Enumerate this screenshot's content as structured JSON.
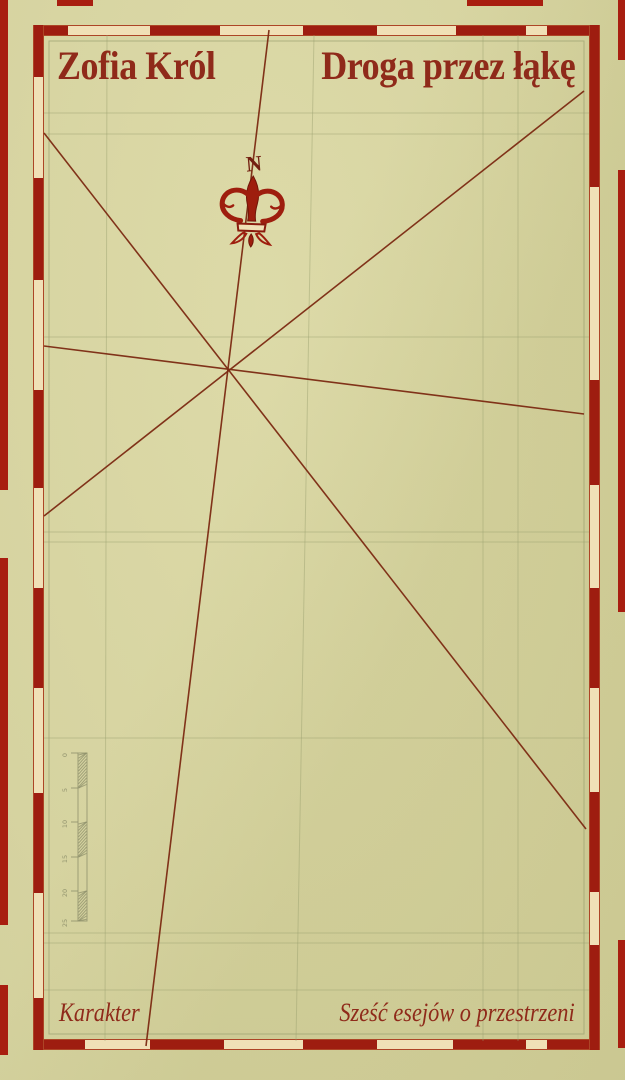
{
  "book": {
    "author": "Zofia Król",
    "title": "Droga przez łąkę",
    "publisher": "Karakter",
    "subtitle": "Sześć esejów o przestrzeni"
  },
  "compass": {
    "cardinal_label": "N"
  },
  "scale_bar": {
    "tick_labels": [
      "0",
      "5",
      "10",
      "15",
      "20",
      "25"
    ],
    "x": 78,
    "w": 9,
    "boundaries": [
      753,
      788,
      822,
      857,
      891,
      921
    ],
    "hatched_segments": [
      0,
      2,
      4
    ],
    "tick_len": 7,
    "label_x": 67
  },
  "colors": {
    "background": "#d8d59e",
    "frame_red": "#9e1d10",
    "ribbon_cream": "#f0e0b6",
    "ribbon_outline": "#ad4526",
    "edge_red": "#a81e10",
    "map_line": "#7c2a12",
    "grid_olive": "#9aa06f",
    "scale_olive": "#8e906b",
    "text_red": "#8f2a1a",
    "fleur_red": "#9e1e0e"
  },
  "artwork": {
    "frame": {
      "x": 33,
      "y": 25,
      "w": 567,
      "h": 1025
    },
    "inner_span": [
      44,
      35,
      589,
      1041
    ],
    "inner_frame_rect": [
      49,
      41,
      584,
      1034
    ],
    "grid_verticals": [
      [
        107,
        35,
        105,
        1041
      ],
      [
        314,
        35,
        296,
        1041
      ],
      [
        483,
        35,
        483,
        1041
      ],
      [
        518,
        35,
        518,
        1041
      ]
    ],
    "grid_horizontals": [
      113,
      134,
      337,
      532,
      542,
      738,
      933,
      943,
      990
    ],
    "map_lines": [
      [
        269,
        30,
        146,
        1046
      ],
      [
        584,
        91,
        44,
        516
      ],
      [
        44,
        133,
        586,
        829
      ],
      [
        44,
        346,
        584,
        414
      ]
    ],
    "ribbon_dashes": {
      "top": [
        [
          33,
          68
        ],
        [
          150,
          220
        ],
        [
          303,
          377
        ],
        [
          456,
          526
        ],
        [
          547,
          600
        ]
      ],
      "bottom": [
        [
          33,
          85
        ],
        [
          150,
          224
        ],
        [
          303,
          377
        ],
        [
          453,
          526
        ],
        [
          547,
          600
        ]
      ],
      "left": [
        [
          25,
          77
        ],
        [
          178,
          280
        ],
        [
          390,
          488
        ],
        [
          588,
          688
        ],
        [
          793,
          893
        ],
        [
          998,
          1050
        ]
      ],
      "right": [
        [
          25,
          187
        ],
        [
          380,
          485
        ],
        [
          588,
          688
        ],
        [
          792,
          892
        ],
        [
          945,
          1050
        ]
      ]
    },
    "edge_dashes": {
      "left": [
        [
          0,
          490
        ],
        [
          558,
          925
        ],
        [
          985,
          1055
        ]
      ],
      "right": [
        [
          0,
          60
        ],
        [
          170,
          612
        ],
        [
          940,
          1048
        ]
      ],
      "top": [
        [
          57,
          93
        ],
        [
          467,
          543
        ]
      ],
      "bottom": []
    }
  }
}
